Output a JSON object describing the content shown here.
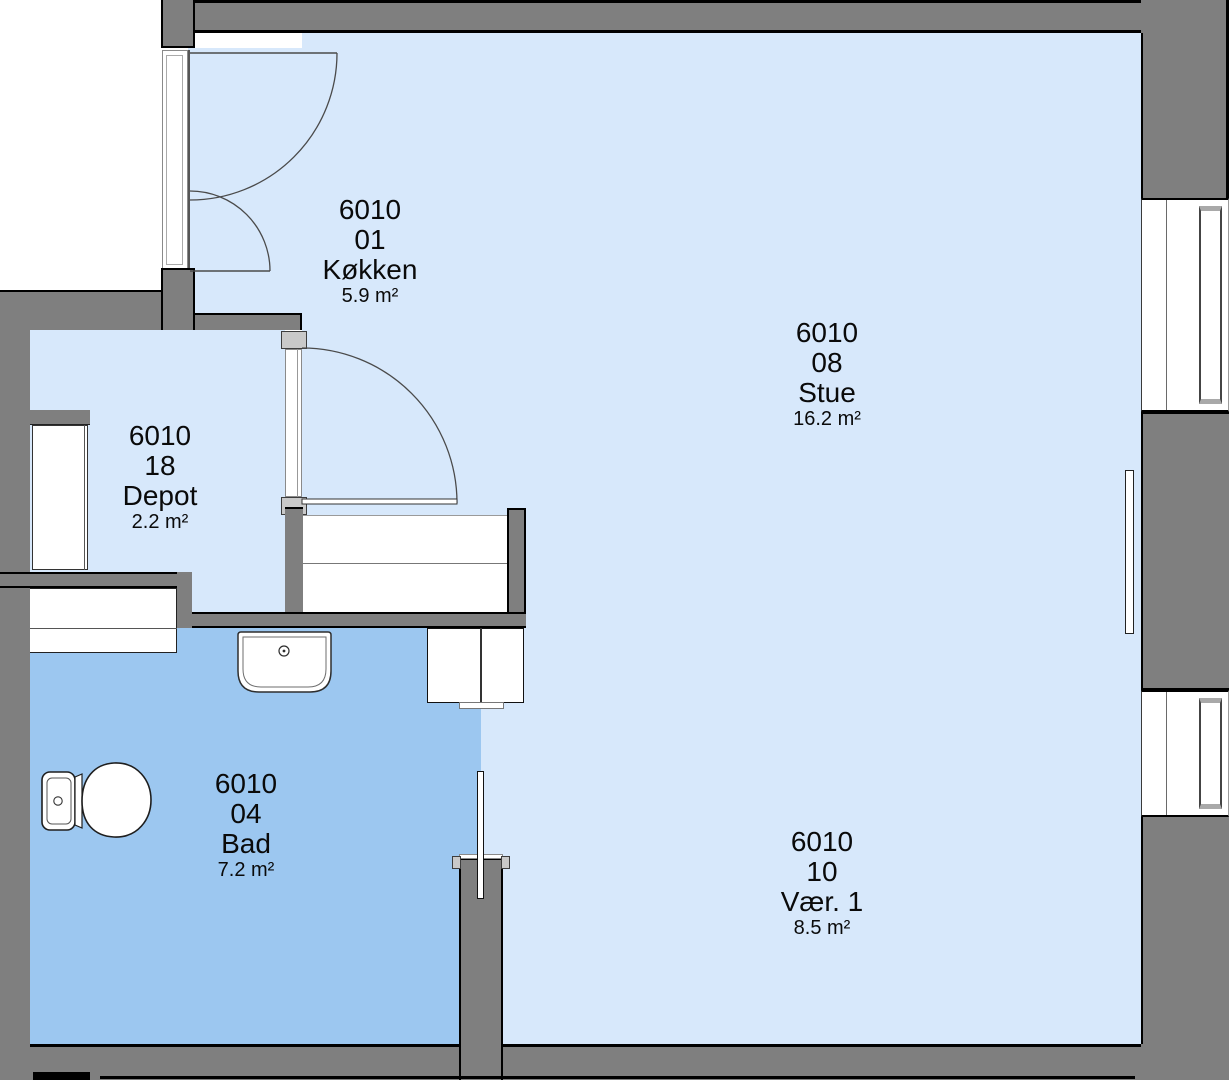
{
  "drawing": {
    "type": "floor-plan",
    "unit_number": "6010"
  },
  "colors": {
    "floor_light": "#d7e8fb",
    "floor_bath": "#9cc7f0",
    "wall_gray": "#7f7f7f",
    "door_jamb_gray": "#c9c9c9",
    "outline_black": "#000000"
  },
  "rooms": [
    {
      "id": "koekken",
      "building": "6010",
      "room_no": "01",
      "name": "Køkken",
      "area": "5.9 m²"
    },
    {
      "id": "stue",
      "building": "6010",
      "room_no": "08",
      "name": "Stue",
      "area": "16.2 m²"
    },
    {
      "id": "depot",
      "building": "6010",
      "room_no": "18",
      "name": "Depot",
      "area": "2.2 m²"
    },
    {
      "id": "bad",
      "building": "6010",
      "room_no": "04",
      "name": "Bad",
      "area": "7.2 m²"
    },
    {
      "id": "vaer1",
      "building": "6010",
      "room_no": "10",
      "name": "Vær. 1",
      "area": "8.5 m²"
    }
  ]
}
